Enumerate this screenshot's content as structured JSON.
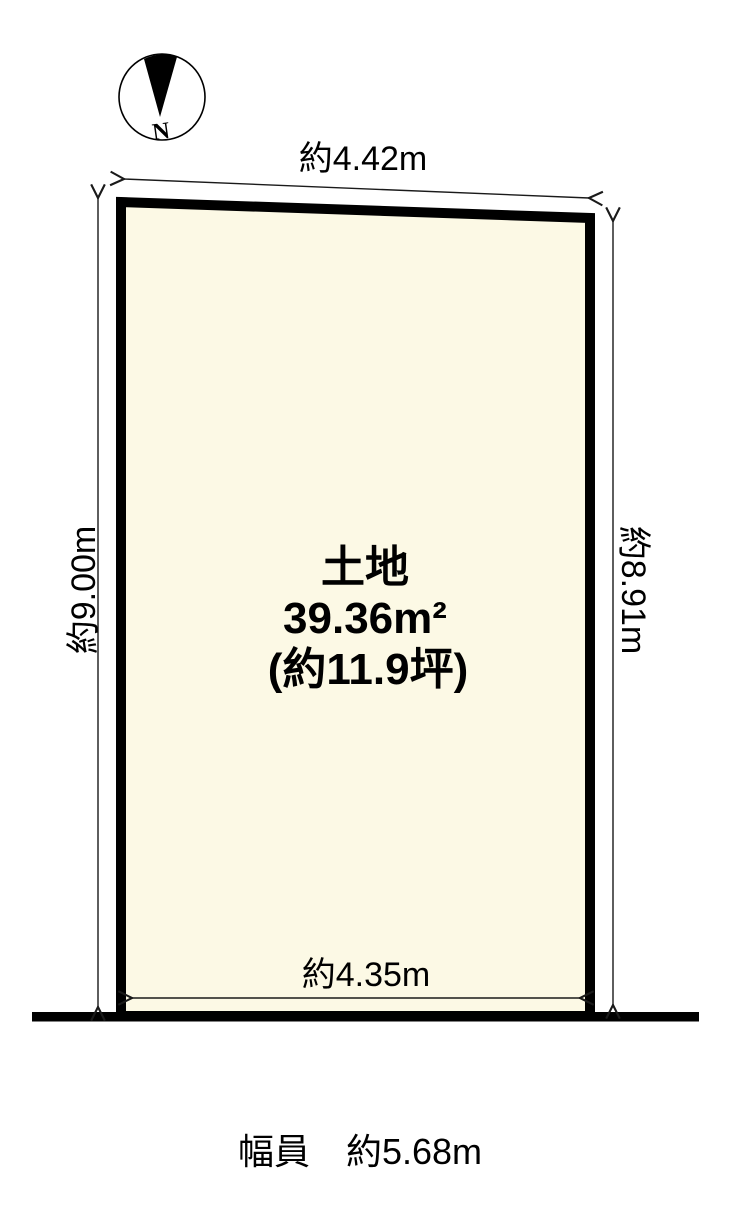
{
  "compass": {
    "north": "N"
  },
  "dimensions": {
    "top": "約4.42m",
    "left": "約9.00m",
    "right": "約8.91m",
    "bottom": "約4.35m"
  },
  "land": {
    "title": "土地",
    "area_m2": "39.36m²",
    "area_tsubo": "(約11.9坪)"
  },
  "road": {
    "width_label": "幅員　約5.68m"
  },
  "colors": {
    "land_fill": "#fcf9e5",
    "outline": "#000000",
    "dim_line": "#1a1a1a"
  }
}
